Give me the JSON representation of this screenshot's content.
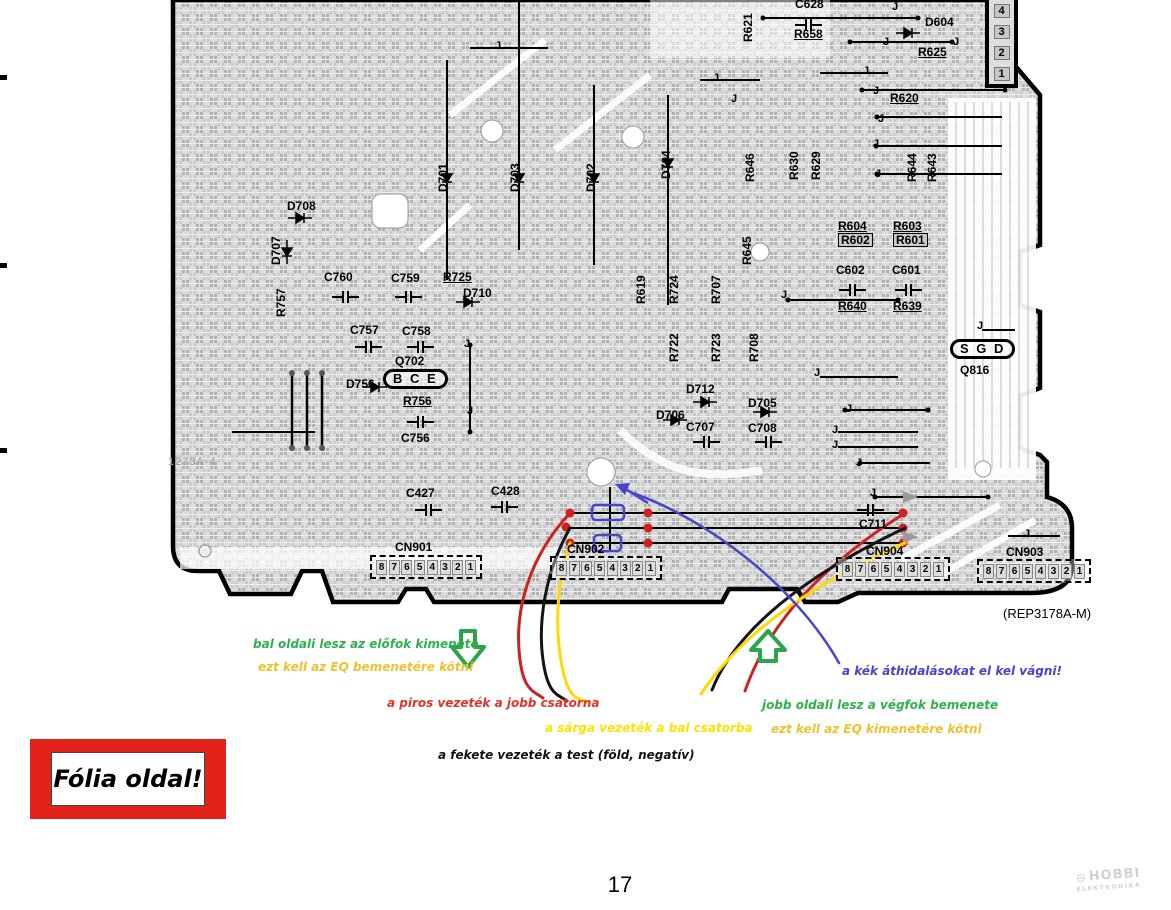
{
  "page": {
    "number": "17"
  },
  "stamp": {
    "title": "Fólia oldal!"
  },
  "footer_logo": {
    "line1": "HOBBI",
    "line2": "ELEKTRONIKA",
    "icon": "circle-minus-icon"
  },
  "colors": {
    "board_ink": "#000000",
    "stamp_red": "#e2231a",
    "wire_red": "#cc2222",
    "wire_yellow": "#ffd903",
    "wire_black": "#141414",
    "jumper_blue": "#4745cb",
    "arrow_green": "#2aa54a",
    "ann_green": "#2eb14d",
    "ann_orange": "#eec22e",
    "ann_red": "#e5312b",
    "ann_yellow": "#ffe104",
    "ann_blue": "#4745cb",
    "ann_black": "#111111"
  },
  "board": {
    "part_number": "(REP3178A-M)",
    "top_connector_pins": [
      "4",
      "3",
      "2",
      "1"
    ],
    "connectors": [
      {
        "name": "CN901",
        "label_x": 395,
        "label_y": 541,
        "x": 370,
        "y": 555,
        "w": 100,
        "pins": [
          "8",
          "7",
          "6",
          "5",
          "4",
          "3",
          "2",
          "1"
        ]
      },
      {
        "name": "CN902",
        "label_x": 567,
        "label_y": 543,
        "x": 550,
        "y": 556,
        "w": 100,
        "pins": [
          "8",
          "7",
          "6",
          "5",
          "4",
          "3",
          "2",
          "1"
        ]
      },
      {
        "name": "CN904",
        "label_x": 866,
        "label_y": 545,
        "x": 836,
        "y": 557,
        "w": 102,
        "pins": [
          "8",
          "7",
          "6",
          "5",
          "4",
          "3",
          "2",
          "1"
        ]
      },
      {
        "name": "CN903",
        "label_x": 1006,
        "label_y": 546,
        "x": 977,
        "y": 559,
        "w": 102,
        "pins": [
          "8",
          "7",
          "6",
          "5",
          "4",
          "3",
          "2",
          "1"
        ]
      }
    ],
    "labels": [
      {
        "t": "C628",
        "x": 795,
        "y": -2
      },
      {
        "t": "R658",
        "x": 794,
        "y": 28,
        "u": 1
      },
      {
        "t": "D604",
        "x": 925,
        "y": 16
      },
      {
        "t": "R625",
        "x": 918,
        "y": 46,
        "u": 1
      },
      {
        "t": "R620",
        "x": 890,
        "y": 92,
        "u": 1
      },
      {
        "t": "R621",
        "x": 742,
        "y": 10,
        "v": 1
      },
      {
        "t": "R630",
        "x": 788,
        "y": 148,
        "v": 1
      },
      {
        "t": "R629",
        "x": 810,
        "y": 148,
        "v": 1
      },
      {
        "t": "R646",
        "x": 744,
        "y": 150,
        "v": 1
      },
      {
        "t": "R644",
        "x": 906,
        "y": 150,
        "v": 1
      },
      {
        "t": "R643",
        "x": 926,
        "y": 150,
        "v": 1
      },
      {
        "t": "D704",
        "x": 660,
        "y": 147,
        "v": 1
      },
      {
        "t": "D701",
        "x": 437,
        "y": 160,
        "v": 1
      },
      {
        "t": "D703",
        "x": 509,
        "y": 160,
        "v": 1
      },
      {
        "t": "D702",
        "x": 585,
        "y": 160,
        "v": 1
      },
      {
        "t": "R604",
        "x": 838,
        "y": 220,
        "u": 1
      },
      {
        "t": "R603",
        "x": 893,
        "y": 220,
        "u": 1
      },
      {
        "t": "R602",
        "x": 838,
        "y": 233,
        "cls": "boxed"
      },
      {
        "t": "R601",
        "x": 893,
        "y": 233,
        "cls": "boxed"
      },
      {
        "t": "C602",
        "x": 836,
        "y": 264
      },
      {
        "t": "C601",
        "x": 892,
        "y": 264
      },
      {
        "t": "R640",
        "x": 838,
        "y": 300,
        "u": 1
      },
      {
        "t": "R639",
        "x": 893,
        "y": 300,
        "u": 1
      },
      {
        "t": "D708",
        "x": 287,
        "y": 200
      },
      {
        "t": "D707",
        "x": 270,
        "y": 233,
        "v": 1
      },
      {
        "t": "R757",
        "x": 275,
        "y": 285,
        "v": 1
      },
      {
        "t": "C760",
        "x": 324,
        "y": 271
      },
      {
        "t": "C759",
        "x": 391,
        "y": 272
      },
      {
        "t": "R725",
        "x": 443,
        "y": 271,
        "u": 1
      },
      {
        "t": "D710",
        "x": 463,
        "y": 287
      },
      {
        "t": "C757",
        "x": 350,
        "y": 324
      },
      {
        "t": "C758",
        "x": 402,
        "y": 325
      },
      {
        "t": "Q702",
        "x": 395,
        "y": 355
      },
      {
        "t": "B C E",
        "x": 383,
        "y": 369,
        "cls": "oval"
      },
      {
        "t": "D756",
        "x": 346,
        "y": 378
      },
      {
        "t": "R756",
        "x": 403,
        "y": 395,
        "u": 1
      },
      {
        "t": "C756",
        "x": 401,
        "y": 432
      },
      {
        "t": "R619",
        "x": 635,
        "y": 272,
        "v": 1
      },
      {
        "t": "R724",
        "x": 668,
        "y": 272,
        "v": 1
      },
      {
        "t": "R707",
        "x": 710,
        "y": 272,
        "v": 1
      },
      {
        "t": "R645",
        "x": 741,
        "y": 233,
        "v": 1
      },
      {
        "t": "R722",
        "x": 668,
        "y": 330,
        "v": 1
      },
      {
        "t": "R723",
        "x": 710,
        "y": 330,
        "v": 1
      },
      {
        "t": "R708",
        "x": 748,
        "y": 330,
        "v": 1
      },
      {
        "t": "D712",
        "x": 686,
        "y": 383
      },
      {
        "t": "D706",
        "x": 656,
        "y": 409
      },
      {
        "t": "C707",
        "x": 686,
        "y": 421
      },
      {
        "t": "D705",
        "x": 748,
        "y": 397
      },
      {
        "t": "C708",
        "x": 748,
        "y": 422
      },
      {
        "t": "S G D",
        "x": 950,
        "y": 339,
        "cls": "oval"
      },
      {
        "t": "Q816",
        "x": 960,
        "y": 364
      },
      {
        "t": "C427",
        "x": 406,
        "y": 487
      },
      {
        "t": "C428",
        "x": 491,
        "y": 485
      },
      {
        "t": "C711",
        "x": 859,
        "y": 518
      },
      {
        "t": "1273A-4",
        "x": 168,
        "y": 456,
        "cls": "faint"
      },
      {
        "t": "J",
        "x": 892,
        "y": 1,
        "cls": "j"
      },
      {
        "t": "J",
        "x": 883,
        "y": 36,
        "cls": "j"
      },
      {
        "t": "J",
        "x": 953,
        "y": 36,
        "cls": "j"
      },
      {
        "t": "J",
        "x": 863,
        "y": 65,
        "cls": "j"
      },
      {
        "t": "J",
        "x": 873,
        "y": 85,
        "cls": "j"
      },
      {
        "t": "J",
        "x": 878,
        "y": 113,
        "cls": "j"
      },
      {
        "t": "J",
        "x": 873,
        "y": 138,
        "cls": "j"
      },
      {
        "t": "J",
        "x": 875,
        "y": 168,
        "cls": "j"
      },
      {
        "t": "J",
        "x": 495,
        "y": 40,
        "cls": "j"
      },
      {
        "t": "J",
        "x": 713,
        "y": 72,
        "cls": "j"
      },
      {
        "t": "J",
        "x": 731,
        "y": 93,
        "cls": "j"
      },
      {
        "t": "J",
        "x": 781,
        "y": 289,
        "cls": "j"
      },
      {
        "t": "J",
        "x": 464,
        "y": 338,
        "cls": "j"
      },
      {
        "t": "J",
        "x": 467,
        "y": 405,
        "cls": "j"
      },
      {
        "t": "J",
        "x": 814,
        "y": 367,
        "cls": "j"
      },
      {
        "t": "J",
        "x": 846,
        "y": 403,
        "cls": "j"
      },
      {
        "t": "J",
        "x": 832,
        "y": 424,
        "cls": "j"
      },
      {
        "t": "J",
        "x": 832,
        "y": 439,
        "cls": "j"
      },
      {
        "t": "J",
        "x": 856,
        "y": 457,
        "cls": "j"
      },
      {
        "t": "J",
        "x": 977,
        "y": 320,
        "cls": "j"
      },
      {
        "t": "J",
        "x": 870,
        "y": 487,
        "cls": "j"
      },
      {
        "t": "J",
        "x": 1024,
        "y": 528,
        "cls": "j"
      }
    ]
  },
  "annotations": {
    "left_green": {
      "text": "bal oldali lesz az előfok kimenete",
      "color": "#2eb14d"
    },
    "left_orange": {
      "text": "ezt kell az EQ bemenetére kötni",
      "color": "#eec22e"
    },
    "red": {
      "text": "a piros vezeték a jobb csatorna",
      "color": "#e5312b"
    },
    "yellow": {
      "text": "a sárga vezeték a bal csatorba",
      "color": "#ffe104"
    },
    "black": {
      "text": "a fekete vezeték a test (föld, negatív)",
      "color": "#111111"
    },
    "blue": {
      "text": "a kék áthidalásokat el kel vágni!",
      "color": "#4745cb"
    },
    "right_green": {
      "text": "jobb oldali lesz a végfok bemenete",
      "color": "#2eb14d"
    },
    "right_orange": {
      "text": "ezt kell az EQ kimenetére kötni",
      "color": "#eec22e"
    }
  }
}
